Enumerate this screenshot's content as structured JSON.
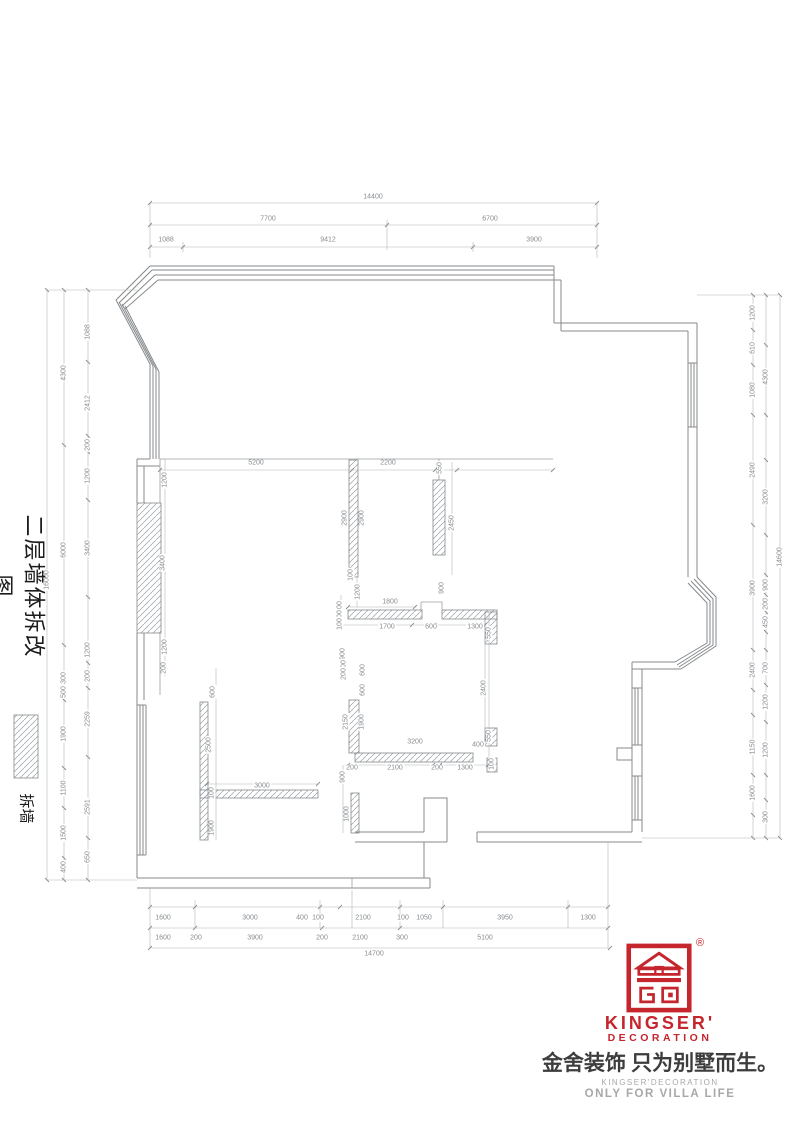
{
  "title": {
    "text": "二层墙体拆改图"
  },
  "legend": {
    "label": "拆墙"
  },
  "logo": {
    "brand": "KINGSER'",
    "brand_sub": "DECORATION",
    "registered": "®",
    "slogan_cn": "金舍装饰 只为别墅而生。",
    "sub_en": "KINGSER'DECORATION",
    "tagline": "ONLY FOR VILLA LIFE",
    "red": "#c5252c",
    "gray": "#a8a8a8"
  },
  "dimensions": {
    "top": [
      {
        "t": "14400",
        "x": 373,
        "y": 197,
        "r": 0
      },
      {
        "t": "7700",
        "x": 268,
        "y": 219,
        "r": 0
      },
      {
        "t": "6700",
        "x": 490,
        "y": 219,
        "r": 0
      },
      {
        "t": "1088",
        "x": 166,
        "y": 240,
        "r": 0
      },
      {
        "t": "9412",
        "x": 328,
        "y": 240,
        "r": 0
      },
      {
        "t": "3900",
        "x": 534,
        "y": 240,
        "r": 0
      }
    ],
    "bottom": [
      {
        "t": "1600",
        "x": 163,
        "y": 918,
        "r": 0
      },
      {
        "t": "3000",
        "x": 250,
        "y": 918,
        "r": 0
      },
      {
        "t": "400",
        "x": 302,
        "y": 918,
        "r": 0
      },
      {
        "t": "100",
        "x": 318,
        "y": 918,
        "r": 0
      },
      {
        "t": "2100",
        "x": 363,
        "y": 918,
        "r": 0
      },
      {
        "t": "100",
        "x": 403,
        "y": 918,
        "r": 0
      },
      {
        "t": "1050",
        "x": 424,
        "y": 918,
        "r": 0
      },
      {
        "t": "3950",
        "x": 505,
        "y": 918,
        "r": 0
      },
      {
        "t": "1300",
        "x": 588,
        "y": 918,
        "r": 0
      },
      {
        "t": "1600",
        "x": 163,
        "y": 938,
        "r": 0
      },
      {
        "t": "200",
        "x": 196,
        "y": 938,
        "r": 0
      },
      {
        "t": "3900",
        "x": 255,
        "y": 938,
        "r": 0
      },
      {
        "t": "200",
        "x": 322,
        "y": 938,
        "r": 0
      },
      {
        "t": "2100",
        "x": 360,
        "y": 938,
        "r": 0
      },
      {
        "t": "300",
        "x": 402,
        "y": 938,
        "r": 0
      },
      {
        "t": "5100",
        "x": 485,
        "y": 938,
        "r": 0
      },
      {
        "t": "14700",
        "x": 374,
        "y": 954,
        "r": 0
      }
    ],
    "left": [
      {
        "t": "16000",
        "x": 47,
        "y": 580,
        "r": -90
      },
      {
        "t": "4300",
        "x": 64,
        "y": 373,
        "r": -90
      },
      {
        "t": "6000",
        "x": 64,
        "y": 550,
        "r": -90
      },
      {
        "t": "300",
        "x": 64,
        "y": 678,
        "r": -90
      },
      {
        "t": "500",
        "x": 64,
        "y": 692,
        "r": -90
      },
      {
        "t": "1900",
        "x": 64,
        "y": 734,
        "r": -90
      },
      {
        "t": "1100",
        "x": 64,
        "y": 788,
        "r": -90
      },
      {
        "t": "1500",
        "x": 64,
        "y": 833,
        "r": -90
      },
      {
        "t": "400",
        "x": 64,
        "y": 867,
        "r": -90
      },
      {
        "t": "1088",
        "x": 88,
        "y": 332,
        "r": -90
      },
      {
        "t": "2412",
        "x": 88,
        "y": 403,
        "r": -90
      },
      {
        "t": "200",
        "x": 88,
        "y": 445,
        "r": -90
      },
      {
        "t": "1200",
        "x": 88,
        "y": 476,
        "r": -90
      },
      {
        "t": "3400",
        "x": 88,
        "y": 548,
        "r": -90
      },
      {
        "t": "1200",
        "x": 88,
        "y": 650,
        "r": -90
      },
      {
        "t": "200",
        "x": 88,
        "y": 676,
        "r": -90
      },
      {
        "t": "2259",
        "x": 88,
        "y": 719,
        "r": -90
      },
      {
        "t": "2591",
        "x": 88,
        "y": 807,
        "r": -90
      },
      {
        "t": "650",
        "x": 88,
        "y": 857,
        "r": -90
      }
    ],
    "right": [
      {
        "t": "1200",
        "x": 753,
        "y": 313,
        "r": -90
      },
      {
        "t": "610",
        "x": 753,
        "y": 348,
        "r": -90
      },
      {
        "t": "1080",
        "x": 753,
        "y": 390,
        "r": -90
      },
      {
        "t": "2490",
        "x": 753,
        "y": 470,
        "r": -90
      },
      {
        "t": "3900",
        "x": 753,
        "y": 588,
        "r": -90
      },
      {
        "t": "2400",
        "x": 753,
        "y": 670,
        "r": -90
      },
      {
        "t": "1150",
        "x": 753,
        "y": 747,
        "r": -90
      },
      {
        "t": "1600",
        "x": 753,
        "y": 793,
        "r": -90
      },
      {
        "t": "4300",
        "x": 766,
        "y": 377,
        "r": -90
      },
      {
        "t": "3200",
        "x": 766,
        "y": 497,
        "r": -90
      },
      {
        "t": "900",
        "x": 766,
        "y": 585,
        "r": -90
      },
      {
        "t": "200",
        "x": 766,
        "y": 604,
        "r": -90
      },
      {
        "t": "450",
        "x": 766,
        "y": 622,
        "r": -90
      },
      {
        "t": "700",
        "x": 766,
        "y": 668,
        "r": -90
      },
      {
        "t": "1200",
        "x": 766,
        "y": 702,
        "r": -90
      },
      {
        "t": "1200",
        "x": 766,
        "y": 750,
        "r": -90
      },
      {
        "t": "300",
        "x": 766,
        "y": 817,
        "r": -90
      },
      {
        "t": "14600",
        "x": 780,
        "y": 557,
        "r": -90
      }
    ],
    "interior": [
      {
        "t": "5200",
        "x": 256,
        "y": 463,
        "r": 0
      },
      {
        "t": "2200",
        "x": 388,
        "y": 463,
        "r": 0
      },
      {
        "t": "1800",
        "x": 390,
        "y": 602,
        "r": 0
      },
      {
        "t": "1700",
        "x": 387,
        "y": 627,
        "r": 0
      },
      {
        "t": "600",
        "x": 431,
        "y": 627,
        "r": 0
      },
      {
        "t": "1300",
        "x": 475,
        "y": 627,
        "r": 0
      },
      {
        "t": "3200",
        "x": 415,
        "y": 742,
        "r": 0
      },
      {
        "t": "200",
        "x": 352,
        "y": 768,
        "r": 0
      },
      {
        "t": "2100",
        "x": 395,
        "y": 768,
        "r": 0
      },
      {
        "t": "200",
        "x": 437,
        "y": 768,
        "r": 0
      },
      {
        "t": "1300",
        "x": 465,
        "y": 768,
        "r": 0
      },
      {
        "t": "3000",
        "x": 262,
        "y": 786,
        "r": 0
      },
      {
        "t": "400",
        "x": 478,
        "y": 745,
        "r": 0
      },
      {
        "t": "1200",
        "x": 165,
        "y": 480,
        "r": -90
      },
      {
        "t": "3400",
        "x": 163,
        "y": 563,
        "r": -90
      },
      {
        "t": "1200",
        "x": 165,
        "y": 647,
        "r": -90
      },
      {
        "t": "200",
        "x": 164,
        "y": 668,
        "r": -90
      },
      {
        "t": "600",
        "x": 213,
        "y": 692,
        "r": -90
      },
      {
        "t": "2500",
        "x": 209,
        "y": 745,
        "r": -90
      },
      {
        "t": "100",
        "x": 212,
        "y": 793,
        "r": -90
      },
      {
        "t": "1900",
        "x": 212,
        "y": 828,
        "r": -90
      },
      {
        "t": "2900",
        "x": 345,
        "y": 518,
        "r": -90
      },
      {
        "t": "2900",
        "x": 362,
        "y": 518,
        "r": -90
      },
      {
        "t": "100",
        "x": 351,
        "y": 575,
        "r": -90
      },
      {
        "t": "1200",
        "x": 358,
        "y": 592,
        "r": -90
      },
      {
        "t": "550",
        "x": 440,
        "y": 468,
        "r": -90
      },
      {
        "t": "2450",
        "x": 452,
        "y": 523,
        "r": -90
      },
      {
        "t": "900",
        "x": 442,
        "y": 588,
        "r": -90
      },
      {
        "t": "400",
        "x": 340,
        "y": 607,
        "r": -90
      },
      {
        "t": "100",
        "x": 340,
        "y": 616,
        "r": -90
      },
      {
        "t": "100",
        "x": 340,
        "y": 624,
        "r": -90
      },
      {
        "t": "900",
        "x": 343,
        "y": 654,
        "r": -90
      },
      {
        "t": "400",
        "x": 344,
        "y": 666,
        "r": -90
      },
      {
        "t": "200",
        "x": 344,
        "y": 674,
        "r": -90
      },
      {
        "t": "600",
        "x": 363,
        "y": 670,
        "r": -90
      },
      {
        "t": "600",
        "x": 363,
        "y": 690,
        "r": -90
      },
      {
        "t": "2150",
        "x": 346,
        "y": 722,
        "r": -90
      },
      {
        "t": "1900",
        "x": 362,
        "y": 722,
        "r": -90
      },
      {
        "t": "550",
        "x": 489,
        "y": 633,
        "r": -90
      },
      {
        "t": "2400",
        "x": 484,
        "y": 688,
        "r": -90
      },
      {
        "t": "550",
        "x": 489,
        "y": 736,
        "r": -90
      },
      {
        "t": "100",
        "x": 492,
        "y": 764,
        "r": -90
      },
      {
        "t": "900",
        "x": 343,
        "y": 777,
        "r": -90
      },
      {
        "t": "1000",
        "x": 347,
        "y": 814,
        "r": -90
      }
    ]
  }
}
